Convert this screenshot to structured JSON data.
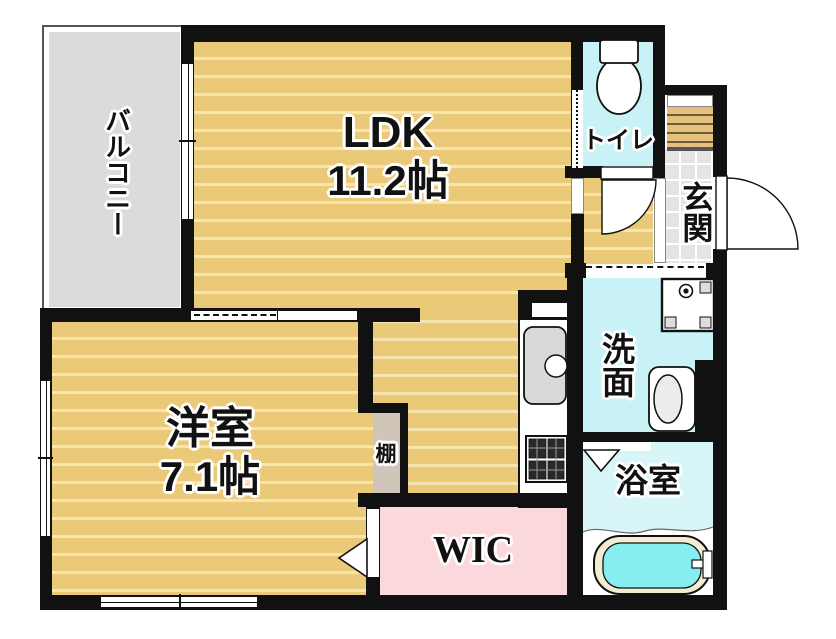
{
  "floorplan": {
    "title": "1LDK floor plan",
    "rooms": {
      "balcony": {
        "label": "バルコニー"
      },
      "ldk": {
        "label": "LDK",
        "size": "11.2帖"
      },
      "western_room": {
        "label": "洋室",
        "size": "7.1帖"
      },
      "toilet": {
        "label": "トイレ"
      },
      "entrance": {
        "label": "玄関"
      },
      "washroom": {
        "label": "洗面"
      },
      "bathroom": {
        "label": "浴室"
      },
      "walk_in_closet": {
        "label": "WIC"
      },
      "shelf": {
        "label": "棚"
      }
    },
    "colors": {
      "wall": "#111111",
      "flooring": "#eac979",
      "flooring_stripe": "#f6e5ad",
      "wet_area_cyan": "#c9f2f6",
      "bathroom_cyan": "#d8f6f8",
      "closet_pink": "#fbd8dc",
      "balcony_gray": "#dbdbdb",
      "shelf_beige": "#cfc5b8",
      "entrance_tile": "#e4e4e4",
      "entrance_step": "#e3c07b",
      "bathtub_water": "#87edf1",
      "bathtub_rim": "#f1ecd2"
    }
  }
}
